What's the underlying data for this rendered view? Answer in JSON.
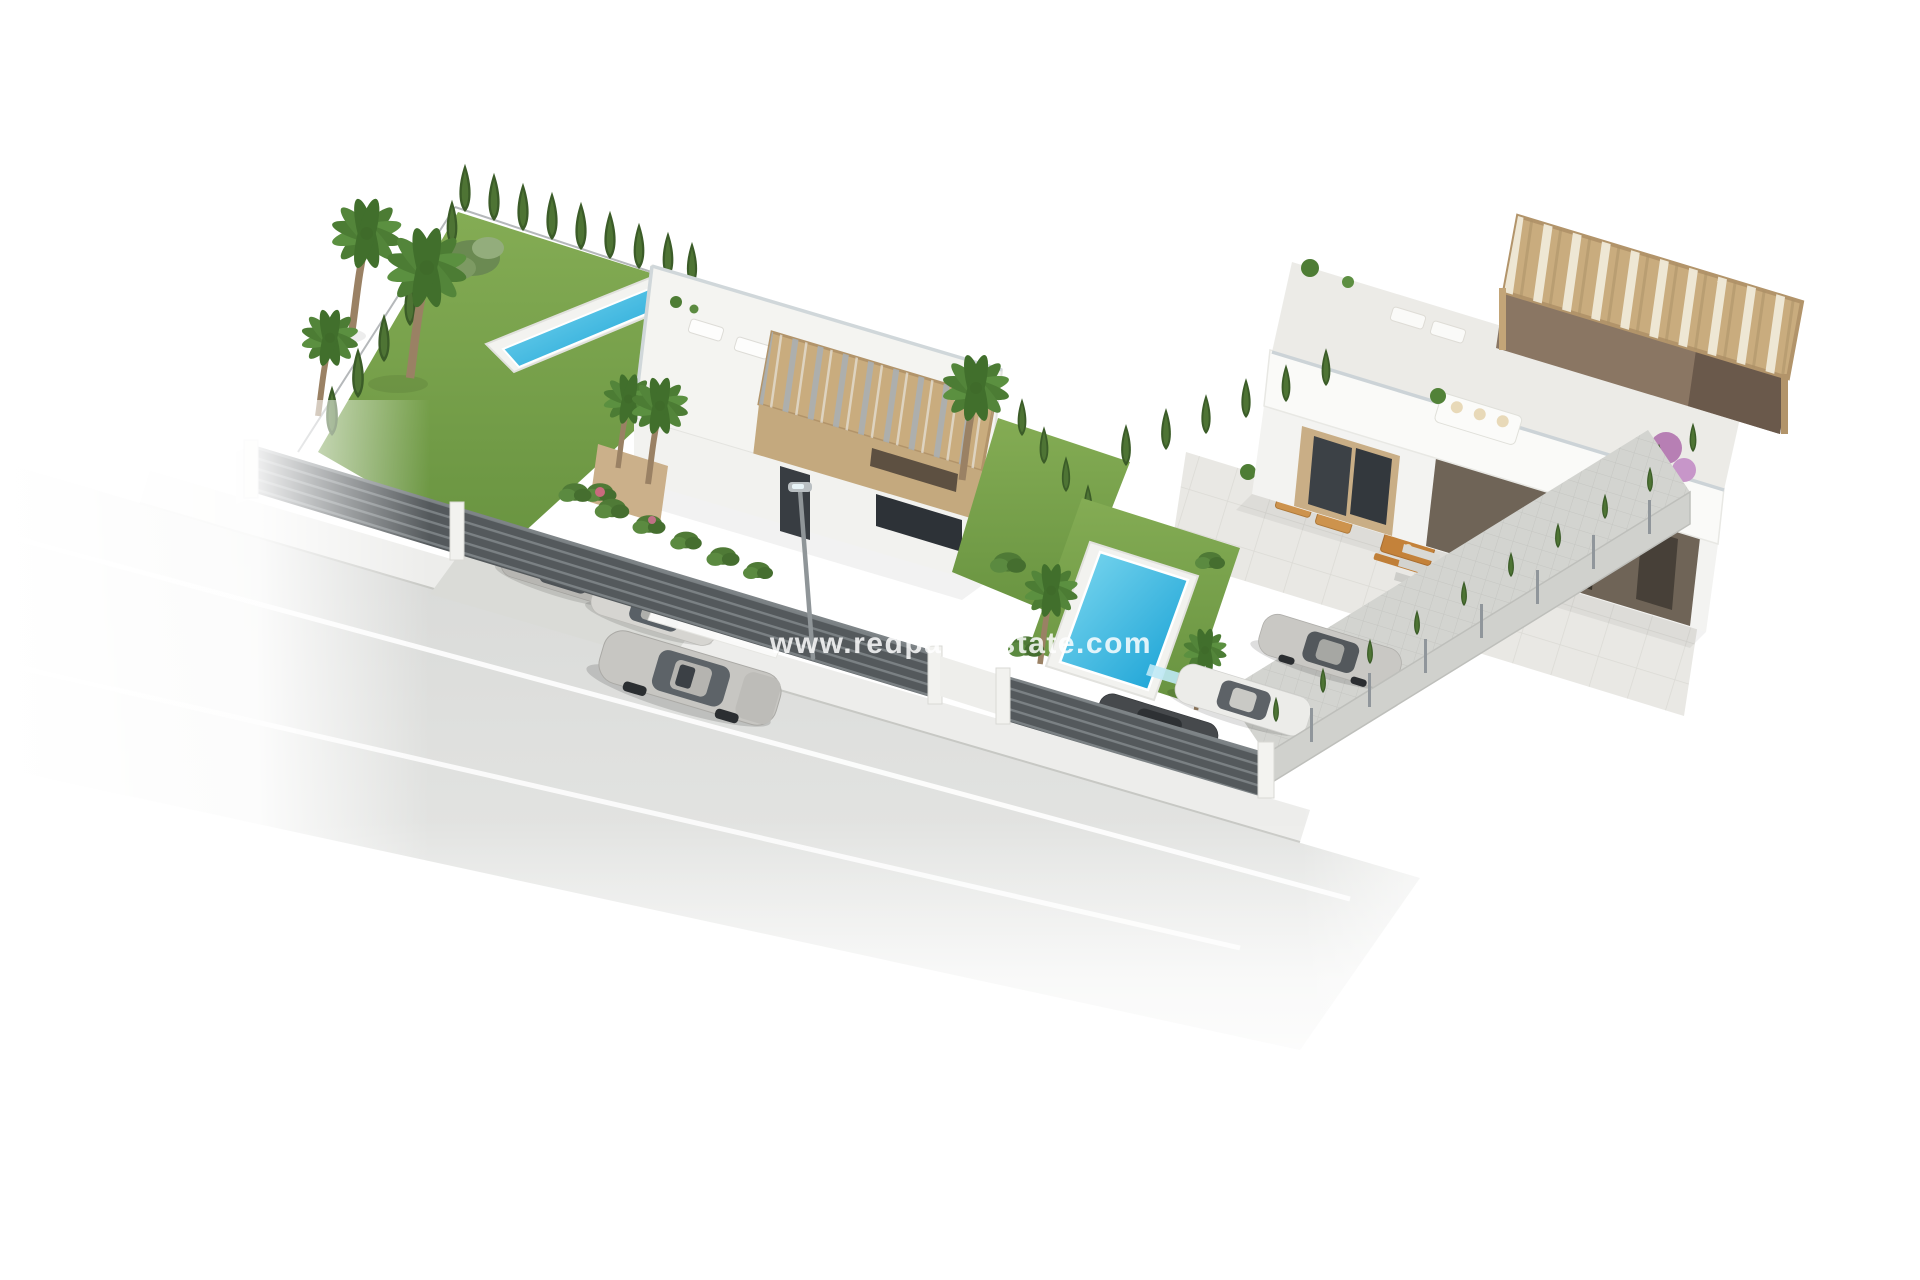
{
  "watermark": {
    "text": "www.redpalmestate.com"
  },
  "palette": {
    "background": "#ffffff",
    "road": "#d7d8d6",
    "sidewalk": "#ededeb",
    "lane_marking": "#ffffff",
    "lawn": "#74a145",
    "cypress_green": "#3f6129",
    "pool_water": "#2fb9e4",
    "fence_dark": "#54595c",
    "wall_white": "#f4f4f2",
    "pergola_wood": "#c9ac7e",
    "pergola_dark": "#6f6457",
    "terrace_tile": "#e9e8e4",
    "car_silver": "#c7c6c2",
    "furniture_wood": "#cf8a3e"
  },
  "scene": {
    "villas": 2,
    "pools": 2,
    "street_cars": 1,
    "carport_cars": 2,
    "driveway_cars": 3
  }
}
